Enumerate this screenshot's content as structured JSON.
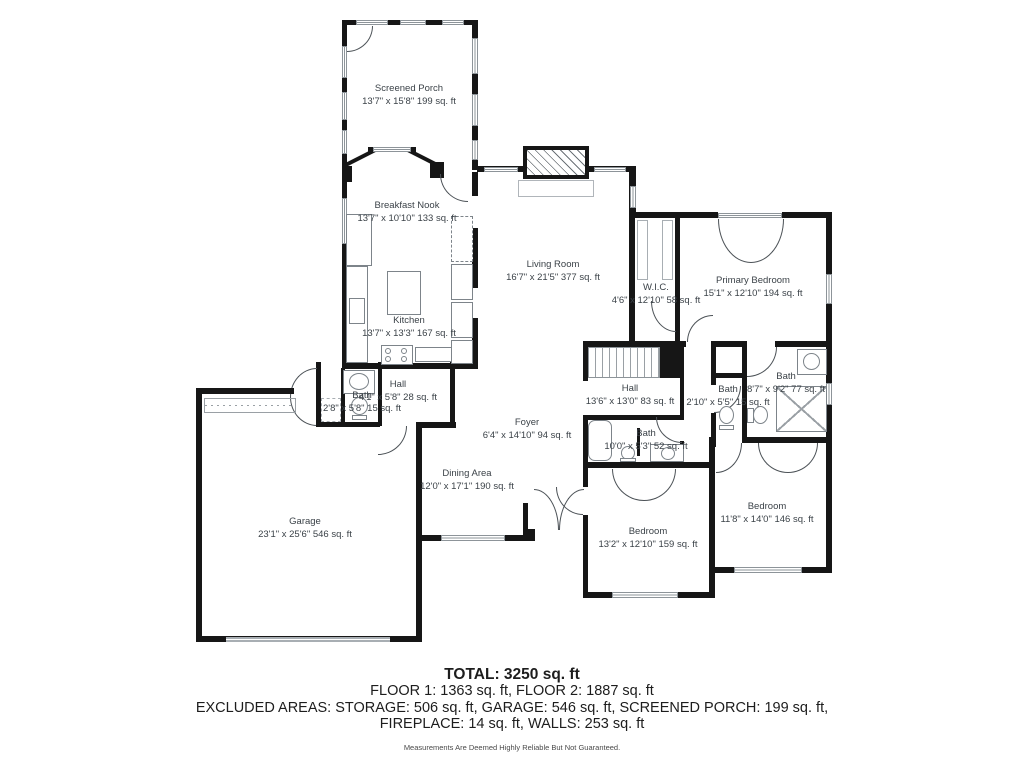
{
  "rooms": [
    {
      "name": "Screened Porch",
      "dims": "13'7\" x 15'8\" 199 sq. ft"
    },
    {
      "name": "Breakfast Nook",
      "dims": "13'7\" x 10'10\" 133 sq. ft"
    },
    {
      "name": "Kitchen",
      "dims": "13'7\" x 13'3\" 167 sq. ft"
    },
    {
      "name": "Living Room",
      "dims": "16'7\" x 21'5\" 377 sq. ft"
    },
    {
      "name": "Primary Bedroom",
      "dims": "15'1\" x 12'10\" 194 sq. ft"
    },
    {
      "name": "W.I.C.",
      "dims": "4'6\" x 12'10\" 58 sq. ft"
    },
    {
      "name": "Hall",
      "dims": "13'6\" x 13'0\" 83 sq. ft"
    },
    {
      "name": "Bath",
      "dims": "8'7\" x 9'2\" 77 sq. ft"
    },
    {
      "name": "Bath",
      "dims": "2'10\" x 5'5\" 15 sq. ft"
    },
    {
      "name": "Foyer",
      "dims": "6'4\" x 14'10\" 94 sq. ft"
    },
    {
      "name": "Bath",
      "dims": "10'0\" x 5'3\" 52 sq. ft"
    },
    {
      "name": "Dining Area",
      "dims": "12'0\" x 17'1\" 190 sq. ft"
    },
    {
      "name": "Hall",
      "dims": "4'1\" x 5'8\" 28 sq. ft"
    },
    {
      "name": "Bath",
      "dims": "2'8\" x 5'8\" 15 sq. ft"
    },
    {
      "name": "Garage",
      "dims": "23'1\" x 25'6\" 546 sq. ft"
    },
    {
      "name": "Bedroom",
      "dims": "13'2\" x 12'10\" 159 sq. ft"
    },
    {
      "name": "Bedroom",
      "dims": "11'8\" x 14'0\" 146 sq. ft"
    }
  ],
  "summary": {
    "total": "TOTAL: 3250 sq. ft",
    "floors": "FLOOR 1: 1363 sq. ft, FLOOR 2: 1887 sq. ft",
    "excluded_line1": "EXCLUDED AREAS: STORAGE: 506 sq. ft, GARAGE: 546 sq. ft, SCREENED PORCH: 199 sq. ft,",
    "excluded_line2": "FIREPLACE: 14 sq. ft, WALLS: 253 sq. ft",
    "disclaimer": "Measurements Are Deemed Highly Reliable But Not Guaranteed."
  },
  "colors": {
    "wall": "#161616",
    "label_text": "#3b4248",
    "window_line": "#8d9499",
    "summary_text": "#1d1d1d"
  }
}
